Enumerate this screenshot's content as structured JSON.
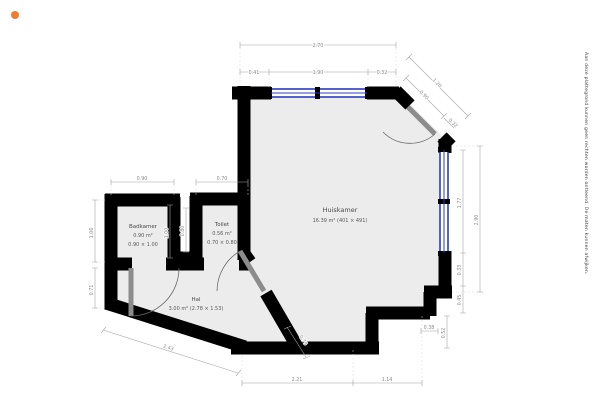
{
  "plan": {
    "rooms": {
      "huiskamer": {
        "name": "Huiskamer",
        "detail": "16.39 m² (401 × 491)"
      },
      "badkamer": {
        "name": "Badkamer",
        "area": "0.90 m²",
        "size": "0.90 × 1.00"
      },
      "toilet": {
        "name": "Toilet",
        "area": "0.56 m²",
        "size": "0.70 × 0.80"
      },
      "hal": {
        "name": "Hal",
        "detail": "3.00 m² (2.78 × 1.53)"
      }
    },
    "dims": {
      "top_total": "2.70",
      "top_left": "0.41",
      "top_mid": "1.90",
      "top_right": "0.32",
      "diag_outer": "1.20",
      "diag_inner": "0.90",
      "diag_small": "0.32",
      "right_window": "1.77",
      "right_a": "0.33",
      "right_b": "0.45",
      "right_total": "2.90",
      "step_w": "0.38",
      "step_h": "0.52",
      "bottom_left": "2.21",
      "bottom_right": "1.14",
      "hal_bottom": "2.43",
      "hal_diag": "0.79",
      "left_top": "1.06",
      "left_bottom": "0.71",
      "badkamer_top": "0.90",
      "toilet_top": "0.70",
      "shaft_a": "1.00",
      "shaft_b": "0.80"
    },
    "disclaimer": "Aan deze plattegrond kunnen geen rechten worden ontleend. De maten kunnen afwijken."
  },
  "colors": {
    "wall": "#000000",
    "floor": "#ececec",
    "window": "#2a3cc4",
    "door": "#8c8c8c",
    "dimension": "#a6a6a6",
    "marker": "#f07d2e"
  }
}
